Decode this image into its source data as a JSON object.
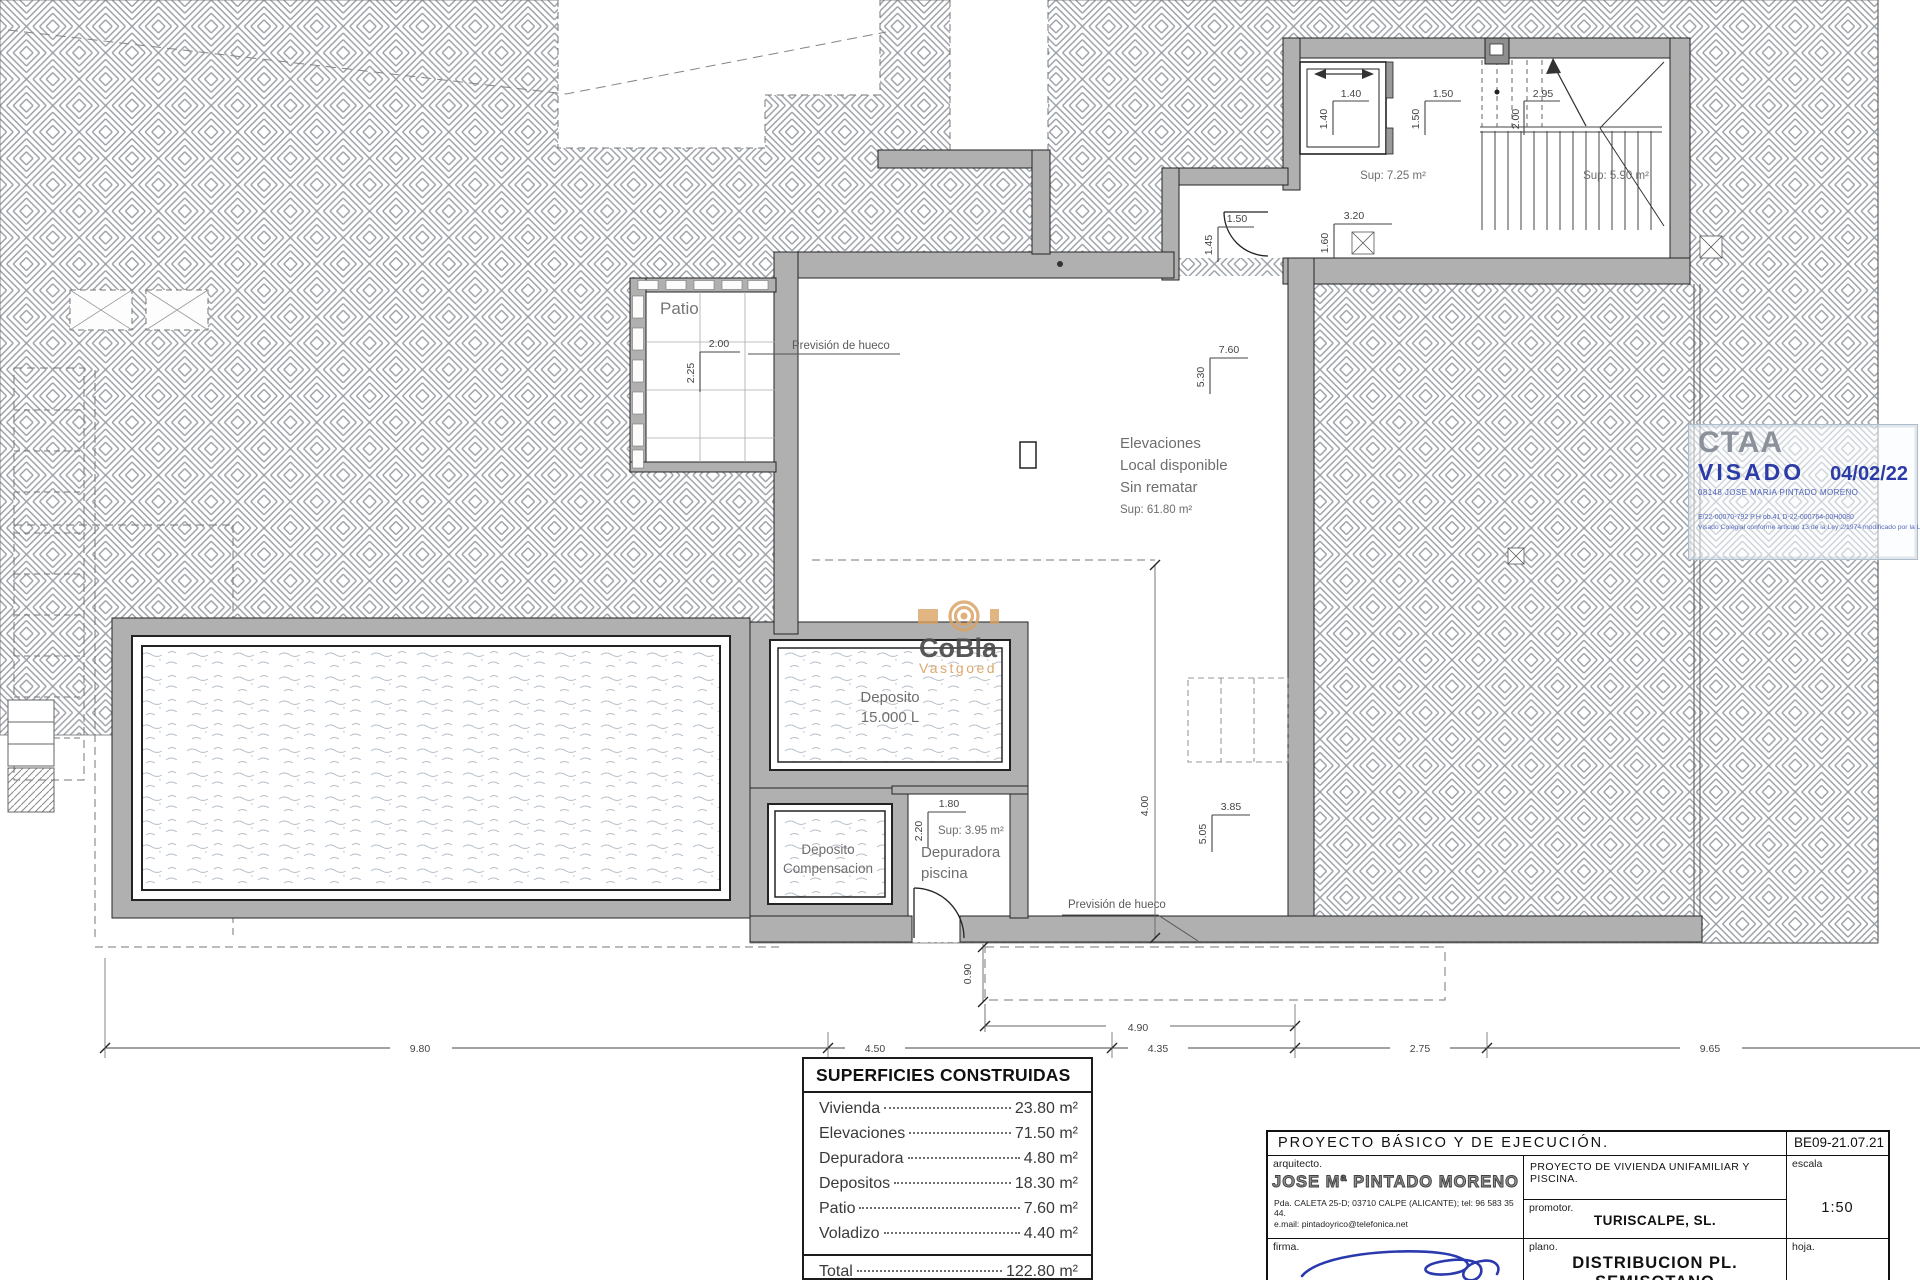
{
  "drawing": {
    "rooms": {
      "patio": "Patio",
      "prevision": "Previsión de hueco",
      "local_lines": [
        "Elevaciones",
        "Local disponible",
        "Sin rematar"
      ],
      "local_sup": "Sup: 61.80 m²",
      "stair_landing_sup": "Sup: 7.25 m²",
      "stair_ramp_sup": "Sup: 5.90 m²",
      "tank_main": [
        "Deposito",
        "15.000 L"
      ],
      "tank_comp": [
        "Deposito",
        "Compensacion"
      ],
      "depuradora": [
        "Depuradora",
        "piscina"
      ],
      "depuradora_sup": "Sup: 3.95 m²"
    },
    "dims": {
      "elevator_w": "1.40",
      "elevator_h": "1.40",
      "landing_w": "1.50",
      "landing_h": "1.50",
      "stair_w": "2.95",
      "stair_h": "2.00",
      "door_w": "1.50",
      "door_h": "1.45",
      "passage_w": "3.20",
      "passage_h": "1.60",
      "patio_w": "2.00",
      "patio_h": "2.25",
      "local_w": "7.60",
      "local_h": "5.30",
      "hueco_w": "3.85",
      "hueco_h": "5.05",
      "hueco_len": "4.00",
      "depuradora_w": "1.80",
      "depuradora_h": "2.20",
      "voladizo_d": "0.90",
      "voladizo_w": "4.90",
      "overall": [
        "9.80",
        "4.50",
        "4.35",
        "2.75",
        "9.65"
      ]
    }
  },
  "areas_table": {
    "title": "SUPERFICIES CONSTRUIDAS",
    "rows": [
      {
        "label": "Vivienda",
        "value": "23.80 m²"
      },
      {
        "label": "Elevaciones",
        "value": "71.50 m²"
      },
      {
        "label": "Depuradora",
        "value": "4.80 m²"
      },
      {
        "label": "Depositos",
        "value": "18.30 m²"
      },
      {
        "label": "Patio",
        "value": "7.60 m²"
      },
      {
        "label": "Voladizo",
        "value": "4.40 m²"
      }
    ],
    "total_label": "Total",
    "total_value": "122.80 m²"
  },
  "title_block": {
    "project": "PROYECTO  BÁSICO  Y  DE  EJECUCIÓN.",
    "code": "BE09-21.07.21",
    "architect_label": "arquitecto.",
    "architect": "JOSE Mª PINTADO MORENO",
    "address": "Pda.  CALETA  25-D;  03710  CALPE  (ALICANTE);  tel:  96 583 35 44.",
    "email": "e.mail:  pintadoyrico@telefonica.net",
    "firma_label": "firma.",
    "project_desc": "PROYECTO  DE  VIVIENDA  UNIFAMILIAR  Y  PISCINA.",
    "promotor_label": "promotor.",
    "promotor": "TURISCALPE,  SL.",
    "plano_label": "plano.",
    "plano": "DISTRIBUCION  PL.  SEMISOTANO",
    "escala_label": "escala",
    "escala": "1:50",
    "hoja_label": "hoja."
  },
  "stamp": {
    "org": "CTAA",
    "visado": "VISADO",
    "date": "04/02/22",
    "holder": "08148 JOSE MARIA PINTADO MORENO",
    "refs": "E/22-00070-792      P.H ob.41      D-22-000764-00H0080",
    "legal": "Visado Colegial conforme artículo 13 de la Ley 2/1974 modificado por la Ley 25/2009"
  },
  "watermark": {
    "name": "CoBla",
    "sub": "Vastgoed"
  }
}
